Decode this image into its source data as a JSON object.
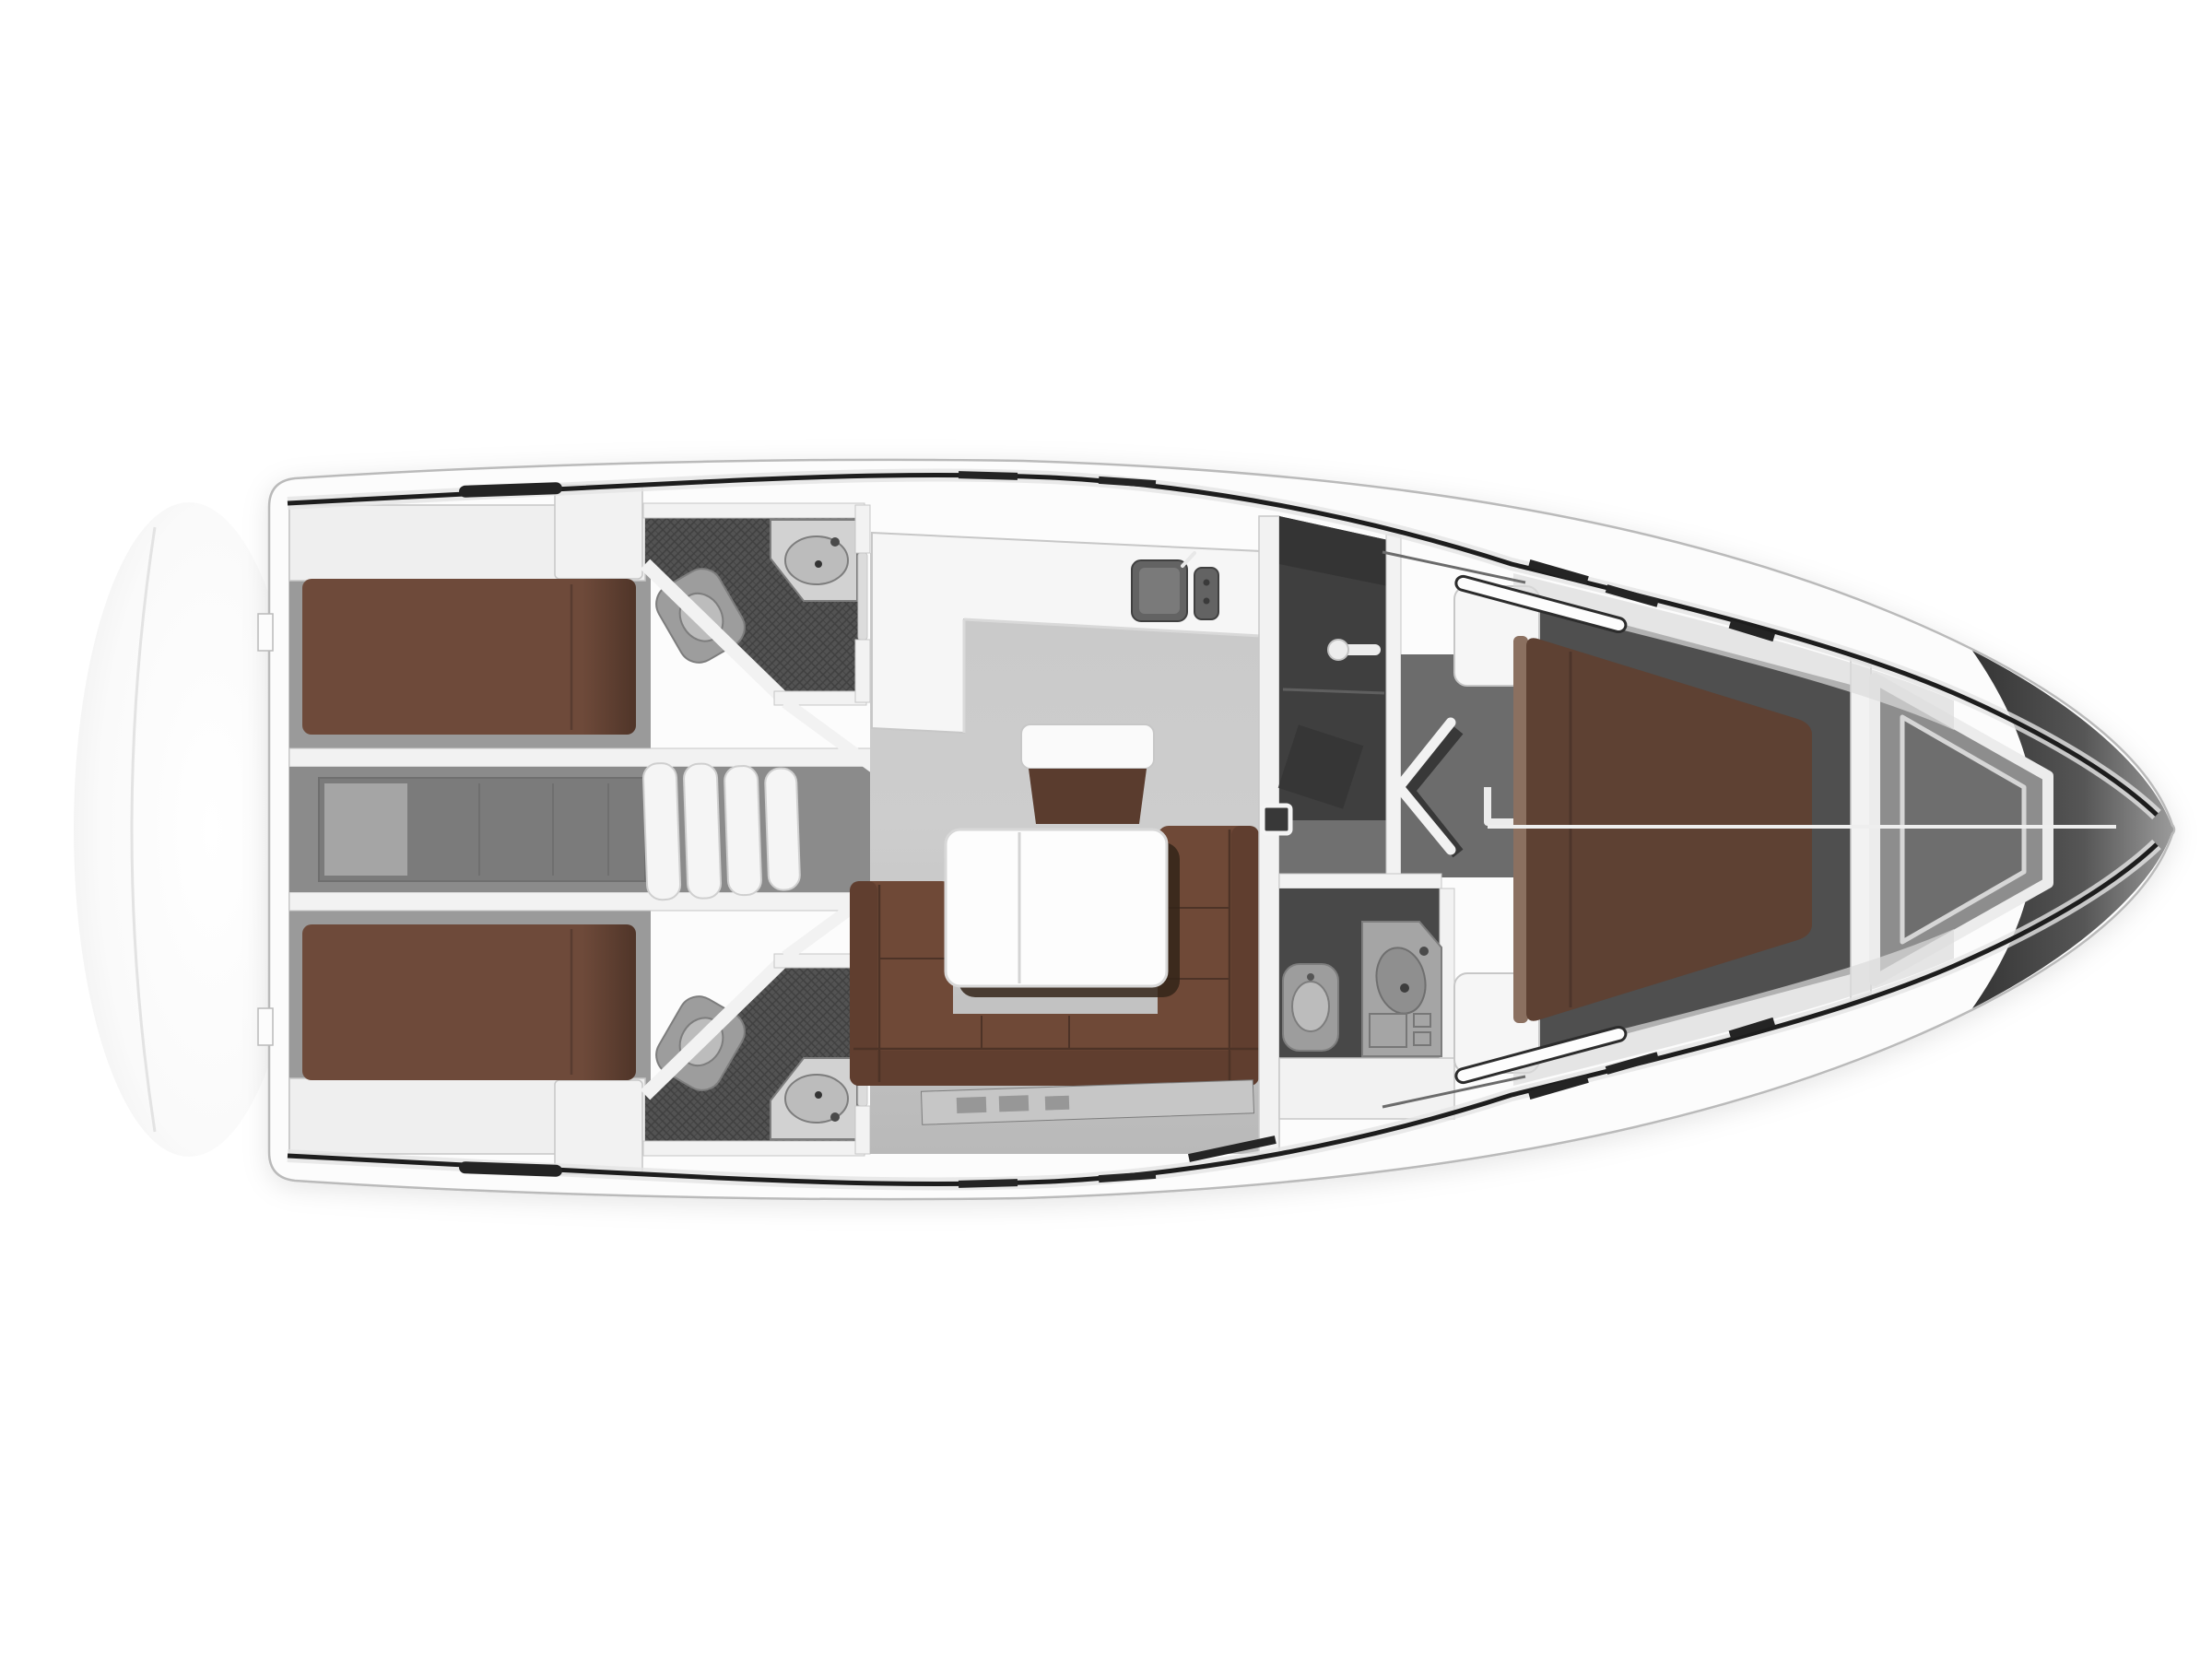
{
  "title": "Sailing yacht interior layout plan, top view: two aft double cabins, two aft heads with showers, saloon with U-sofa and folding table, L-shaped galley, companionway steps, engine compartment, forward head with separate shower and WC, V-berth owner cabin and anchor locker in the bow",
  "colors": {
    "background": "#ffffff",
    "hull_fill": "#fcfcfc",
    "hull_edge": "#bababa",
    "bulwark_shade": "#dcdcdc",
    "deck_line": "#1d1d1d",
    "deck_line_soft": "#e3e3e3",
    "wall_fill": "#f2f2f2",
    "wall_stroke": "#c7c7c7",
    "shelf_fill": "#efefef",
    "floor_saloon_a": "#cbcbcb",
    "floor_saloon_b": "#bcbcbc",
    "floor_cabin_aft": "#9a9a9a",
    "floor_corridor": "#8b8b8b",
    "floor_fwd_cabin": "#4f4f4f",
    "engine_box": "#7b7b7b",
    "engine_panel": "#a5a5a5",
    "engine_line": "#6f6f6f",
    "step_fill": "#f5f5f5",
    "step_stroke": "#cfcfcf",
    "shower_floor": "#535353",
    "hatch_line": "#404040",
    "room_shower": "#3f3f3f",
    "room_counter": "#343434",
    "room_wc": "#484848",
    "passage": "#6c6c6c",
    "entry_floor": "#707070",
    "fixture_base": "#9d9d9d",
    "fixture_bowl": "#bcbcbc",
    "fixture_stroke": "#7d7d7d",
    "fixture_dark": "#8f8f8f",
    "sink_unit": "#636363",
    "sink_inner": "#7a7a7a",
    "counter_top": "#f6f6f6",
    "counter_edge": "#d9d9d9",
    "sink_counter": "#d2d2d2",
    "bed_aft": "#6e4a3a",
    "bed_fwd": "#5e4133",
    "bed_trim": "#8b7060",
    "bed_seam": "#4a332a",
    "sofa": "#6f4937",
    "sofa_back": "#603e2f",
    "sofa_seam": "#4d3327",
    "bench_brown": "#5a3c2e",
    "bench_top": "#fafafa",
    "table_top": "#fdfdfd",
    "table_edge": "#d8d8d8",
    "table_divider": "#d4d4d4",
    "table_shadow": "#342519",
    "kick_strip": "#c6c6c6",
    "kick_box": "#979797",
    "seam_white": "#eeeeee",
    "chevron_white": "#f2f2f2",
    "chevron_shadow": "#383838",
    "handle_fill": "#383838",
    "handle_stroke": "#f4f4f4",
    "window_slot": "#242424",
    "track_fill": "#fdfdfd",
    "track_stroke": "#2c2c2c",
    "locker": "#8d8d8d",
    "locker_inner": "#6e6e6e",
    "locker_trim": "#ececec",
    "locker_trim2": "#d6d6d6",
    "cone_a": "#343434",
    "cone_b": "#565656",
    "cone_c": "#9c9c9c",
    "platform_arc": "#e3e3e3",
    "mixer_white": "#ededed",
    "door_panel": "#dcdcdc"
  }
}
